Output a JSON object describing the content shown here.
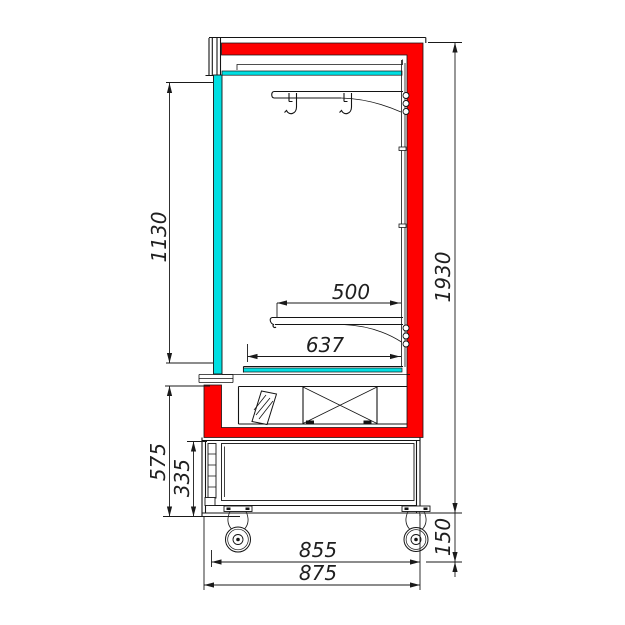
{
  "drawing": {
    "subject": "refrigerated display case side section",
    "colors": {
      "frame_highlight": "#fe0000",
      "glass": "#00dfe2",
      "lines": "#141414",
      "background": "#ffffff"
    },
    "dimensions": {
      "glass_front_height": "1130",
      "overall_height": "1930",
      "shelf_depth": "500",
      "deck_depth": "637",
      "lower_section_height": "575",
      "service_panel_height": "335",
      "base_depth": "855",
      "overall_depth": "875",
      "caster_clearance_height": "150"
    }
  }
}
